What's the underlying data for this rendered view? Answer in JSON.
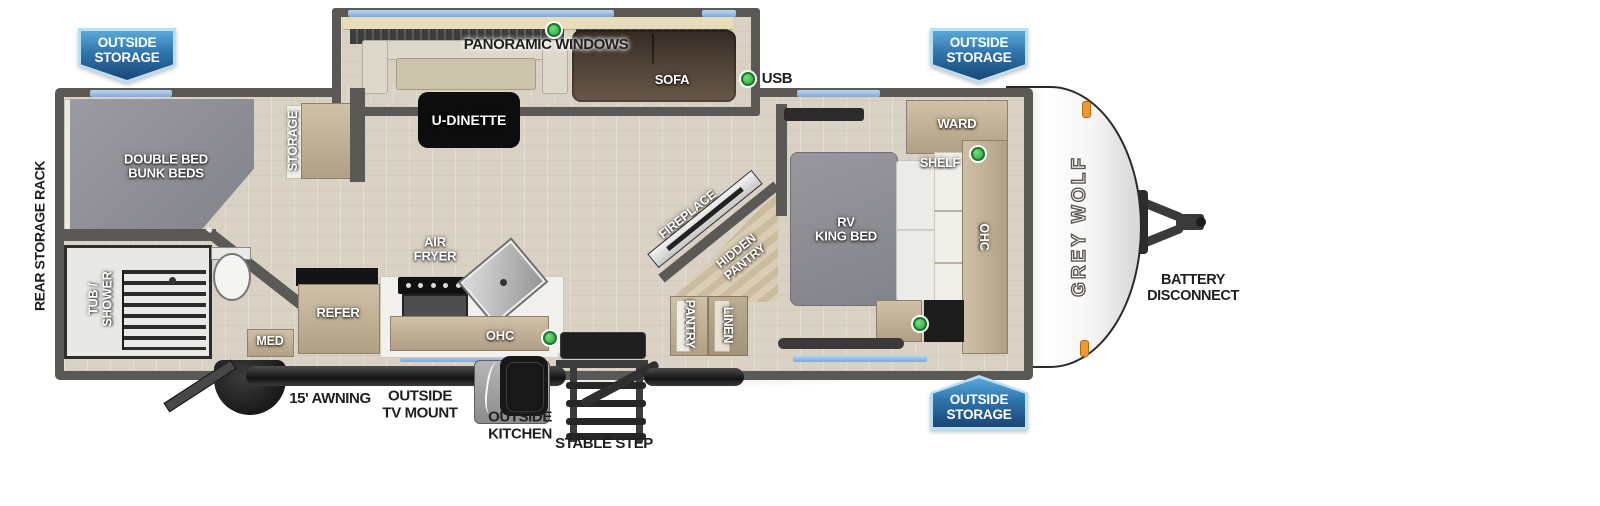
{
  "badges": {
    "rear_top": "OUTSIDE\nSTORAGE",
    "front_top": "OUTSIDE\nSTORAGE",
    "front_bottom": "OUTSIDE\nSTORAGE"
  },
  "exterior": {
    "rear_storage_rack": "REAR STORAGE RACK",
    "awning": "15' AWNING",
    "tv_mount": "OUTSIDE\nTV MOUNT",
    "outside_kitchen": "OUTSIDE\nKITCHEN",
    "stable_step": "STABLE STEP",
    "battery_disconnect": "BATTERY\nDISCONNECT",
    "brand": "GREY WOLF"
  },
  "living": {
    "panoramic_windows": "PANORAMIC WINDOWS",
    "u_dinette": "U-DINETTE",
    "sofa": "SOFA",
    "usb": "USB",
    "fireplace": "FIREPLACE",
    "hidden_pantry": "HIDDEN\nPANTRY",
    "pantry": "PANTRY",
    "linen": "LINEN"
  },
  "kitchen": {
    "air_fryer": "AIR\nFRYER",
    "refer": "REFER",
    "ohc": "OHC",
    "med": "MED"
  },
  "bunk_room": {
    "bed": "DOUBLE BED\nBUNK BEDS",
    "storage": "STORAGE"
  },
  "bathroom": {
    "tub_shower": "TUB /\nSHOWER"
  },
  "bedroom": {
    "bed": "RV\nKING BED",
    "ward": "WARD",
    "shelf": "SHELF",
    "ohc": "OHC"
  },
  "colors": {
    "badge_blue_light": "#5aa9d9",
    "badge_blue_dark": "#1b4574",
    "badge_border": "#b7e1f3",
    "wall_gray": "#5a5955",
    "floor_tan": "#d8d1c4",
    "window_blue": "#8fb9e0",
    "usb_green": "#3db54a",
    "bed_gray": "#8e8e95",
    "cabinet_tan": "#c3b49c",
    "sofa_brown": "#52443a",
    "accent_orange": "#f0962d"
  }
}
